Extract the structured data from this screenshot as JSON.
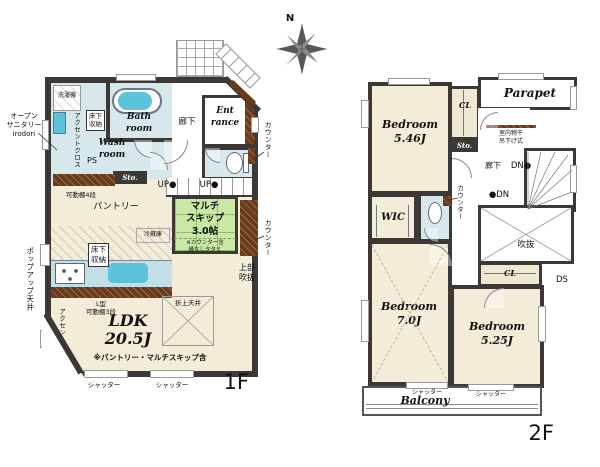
{
  "compass": {
    "north": "N"
  },
  "colors": {
    "wall": "#3b3836",
    "floor_beige": "#f2ecd8",
    "wet_blue": "#d6e8eb",
    "tatami_green": "#cbe7a6",
    "wood_brown": "#6b3a1a",
    "fixture_blue": "#5cc3da",
    "counter_blue": "#c2dfe7"
  },
  "floor1": {
    "floor_label": "1F",
    "open_sanitary": "オープン\nサニタリー\nirodori",
    "washer": "洗濯機",
    "accent_cloth": "アクセントクロス",
    "underfloor_storage": "床下\n収納",
    "bath_room": "Bath\nroom",
    "wash_room": "Wash\nroom",
    "ps": "PS",
    "hallway": "廊下",
    "entrance": "Ent\nrance",
    "storage": "Sto.",
    "movable_shelf_4": "可動棚4段",
    "pantry": "パントリー",
    "fridge": "冷蔵庫",
    "up": "UP●",
    "multi_skip": "マルチ\nスキップ\n3.0帖",
    "multi_skip_note": "※カウンター含\n縁なしタタミ",
    "counter": "カウンター",
    "upper_void": "上部\n吹抜",
    "popup_ceiling": "ポップアップ天井",
    "l_shelf": "L型\n可動棚3段",
    "ldk": "LDK\n20.5J",
    "ldk_note": "※パントリー・マルチスキップ含",
    "coffered_ceiling": "折上天井",
    "shutter": "シャッター"
  },
  "floor2": {
    "floor_label": "2F",
    "bedroom_546": "Bedroom\n5.46J",
    "closet": "CL",
    "storage": "Sto.",
    "parapet": "Parapet",
    "indoor_drying": "室内物干\n吊下げ式",
    "hallway": "廊下",
    "down": "DN●",
    "down2": "●DN",
    "counter": "カウンター",
    "wic": "WIC",
    "void": "吹抜",
    "ds": "DS",
    "closet2": "CL",
    "bedroom_70": "Bedroom\n7.0J",
    "bedroom_525": "Bedroom\n5.25J",
    "balcony": "Balcony",
    "shutter": "シャッター"
  }
}
